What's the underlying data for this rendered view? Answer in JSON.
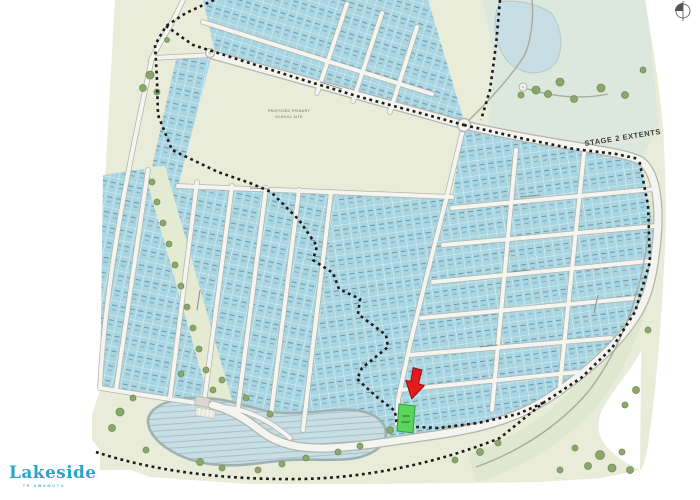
{
  "branding": {
    "name": "Lakeside",
    "tagline": "TE AWAMUTU",
    "brand_color": "#2ba6c9"
  },
  "annotations": {
    "stage_label": "STAGE 2 EXTENTS",
    "school_line1": "PROPOSED PRIMARY",
    "school_line2": "SCHOOL SITE",
    "highlight_lot": {
      "number": "1503",
      "area": "626m²"
    }
  },
  "colors": {
    "lot_fill": "#a8d5e1",
    "highlight_green": "#5ad45a",
    "arrow_red": "#e41b1d",
    "open_space": "#e9ecd8",
    "water": "#c6dee4",
    "boundary": "#1b1b1b"
  }
}
